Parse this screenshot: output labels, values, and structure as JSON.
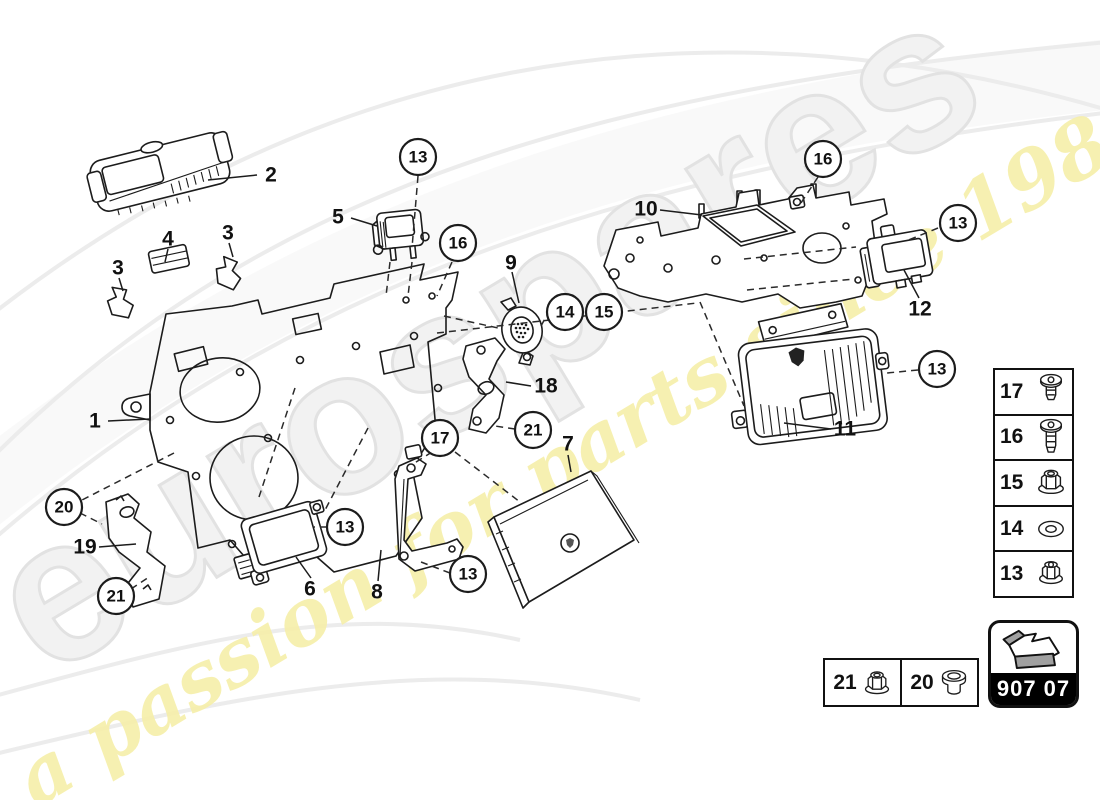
{
  "page": {
    "background": "#ffffff",
    "line_color": "#1c1c1c"
  },
  "watermark": {
    "brand_text": "eurospares",
    "tagline_text": "a passion for parts since 1985",
    "brand_fill": "#f2f2f2",
    "brand_outline": "#e2e2e2",
    "tagline_color": "#f6efa9"
  },
  "part_code_badge": {
    "code": "907 07",
    "icon": "direction-arrow-icon",
    "band_color": "#000000",
    "text_color": "#ffffff"
  },
  "legend": {
    "rows": [
      {
        "number": "17",
        "icon": "short-screw-icon"
      },
      {
        "number": "16",
        "icon": "long-screw-icon"
      },
      {
        "number": "15",
        "icon": "flange-nut-icon"
      },
      {
        "number": "14",
        "icon": "washer-icon"
      },
      {
        "number": "13",
        "icon": "lock-nut-icon"
      }
    ]
  },
  "fastener_boxes": {
    "cells": [
      {
        "number": "21",
        "icon": "flange-nut-icon"
      },
      {
        "number": "20",
        "icon": "grommet-icon"
      }
    ]
  },
  "diagram": {
    "part_labels": [
      {
        "label": "1",
        "x": 95,
        "y": 421
      },
      {
        "label": "2",
        "x": 271,
        "y": 175
      },
      {
        "label": "3",
        "x": 118,
        "y": 268
      },
      {
        "label": "3",
        "x": 228,
        "y": 233
      },
      {
        "label": "4",
        "x": 168,
        "y": 239
      },
      {
        "label": "5",
        "x": 338,
        "y": 217
      },
      {
        "label": "6",
        "x": 310,
        "y": 589
      },
      {
        "label": "7",
        "x": 568,
        "y": 444
      },
      {
        "label": "8",
        "x": 377,
        "y": 592
      },
      {
        "label": "9",
        "x": 511,
        "y": 263
      },
      {
        "label": "10",
        "x": 646,
        "y": 209
      },
      {
        "label": "11",
        "x": 845,
        "y": 429
      },
      {
        "label": "12",
        "x": 920,
        "y": 309
      },
      {
        "label": "18",
        "x": 546,
        "y": 386
      },
      {
        "label": "19",
        "x": 85,
        "y": 547
      }
    ],
    "callouts": [
      {
        "label": "13",
        "x": 418,
        "y": 157
      },
      {
        "label": "16",
        "x": 458,
        "y": 243
      },
      {
        "label": "14",
        "x": 565,
        "y": 312
      },
      {
        "label": "15",
        "x": 604,
        "y": 312
      },
      {
        "label": "16",
        "x": 823,
        "y": 159
      },
      {
        "label": "13",
        "x": 958,
        "y": 223
      },
      {
        "label": "13",
        "x": 937,
        "y": 369
      },
      {
        "label": "17",
        "x": 440,
        "y": 438
      },
      {
        "label": "21",
        "x": 533,
        "y": 430
      },
      {
        "label": "13",
        "x": 345,
        "y": 527
      },
      {
        "label": "13",
        "x": 468,
        "y": 574
      },
      {
        "label": "20",
        "x": 64,
        "y": 507
      },
      {
        "label": "21",
        "x": 116,
        "y": 596
      }
    ]
  }
}
